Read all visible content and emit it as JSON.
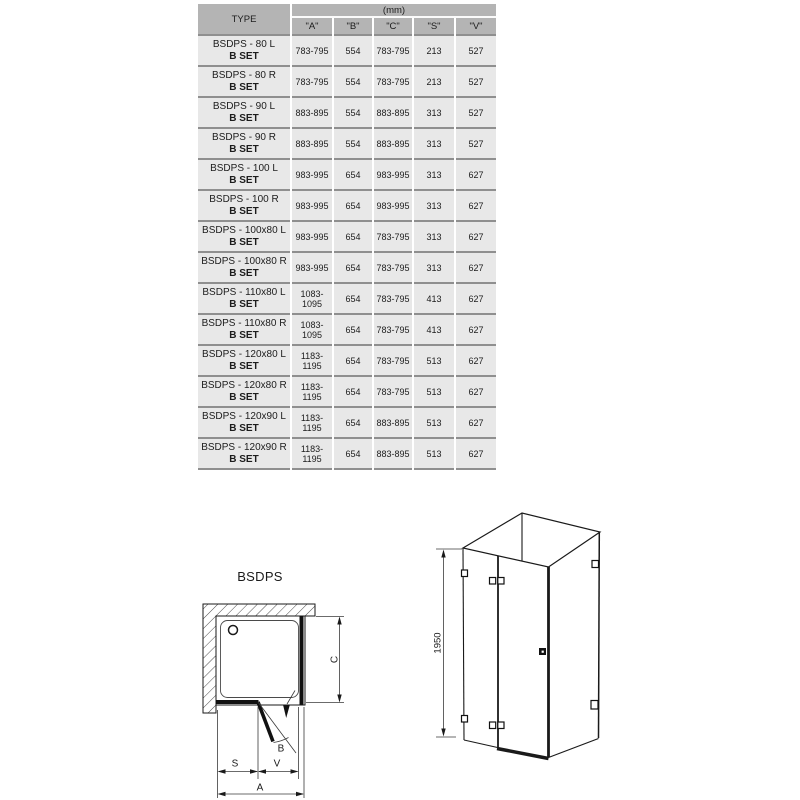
{
  "table": {
    "type_header": "TYPE",
    "unit_header": "(mm)",
    "columns": [
      "\"A\"",
      "\"B\"",
      "\"C\"",
      "\"S\"",
      "\"V\""
    ],
    "rows": [
      {
        "model": "BSDPS - 80 L",
        "set": "B SET",
        "a": "783-795",
        "b": "554",
        "c": "783-795",
        "s": "213",
        "v": "527"
      },
      {
        "model": "BSDPS - 80 R",
        "set": "B SET",
        "a": "783-795",
        "b": "554",
        "c": "783-795",
        "s": "213",
        "v": "527"
      },
      {
        "model": "BSDPS - 90 L",
        "set": "B SET",
        "a": "883-895",
        "b": "554",
        "c": "883-895",
        "s": "313",
        "v": "527"
      },
      {
        "model": "BSDPS - 90 R",
        "set": "B SET",
        "a": "883-895",
        "b": "554",
        "c": "883-895",
        "s": "313",
        "v": "527"
      },
      {
        "model": "BSDPS - 100 L",
        "set": "B SET",
        "a": "983-995",
        "b": "654",
        "c": "983-995",
        "s": "313",
        "v": "627"
      },
      {
        "model": "BSDPS - 100 R",
        "set": "B SET",
        "a": "983-995",
        "b": "654",
        "c": "983-995",
        "s": "313",
        "v": "627"
      },
      {
        "model": "BSDPS - 100x80 L",
        "set": "B SET",
        "a": "983-995",
        "b": "654",
        "c": "783-795",
        "s": "313",
        "v": "627"
      },
      {
        "model": "BSDPS - 100x80 R",
        "set": "B SET",
        "a": "983-995",
        "b": "654",
        "c": "783-795",
        "s": "313",
        "v": "627"
      },
      {
        "model": "BSDPS - 110x80 L",
        "set": "B SET",
        "a": "1083-1095",
        "b": "654",
        "c": "783-795",
        "s": "413",
        "v": "627"
      },
      {
        "model": "BSDPS - 110x80 R",
        "set": "B SET",
        "a": "1083-1095",
        "b": "654",
        "c": "783-795",
        "s": "413",
        "v": "627"
      },
      {
        "model": "BSDPS - 120x80 L",
        "set": "B SET",
        "a": "1183-1195",
        "b": "654",
        "c": "783-795",
        "s": "513",
        "v": "627"
      },
      {
        "model": "BSDPS - 120x80 R",
        "set": "B SET",
        "a": "1183-1195",
        "b": "654",
        "c": "783-795",
        "s": "513",
        "v": "627"
      },
      {
        "model": "BSDPS - 120x90 L",
        "set": "B SET",
        "a": "1183-1195",
        "b": "654",
        "c": "883-895",
        "s": "513",
        "v": "627"
      },
      {
        "model": "BSDPS - 120x90 R",
        "set": "B SET",
        "a": "1183-1195",
        "b": "654",
        "c": "883-895",
        "s": "513",
        "v": "627"
      }
    ]
  },
  "diagram_top_view": {
    "title": "BSDPS",
    "dim_c": "C",
    "dim_s": "S",
    "dim_v": "V",
    "dim_a": "A",
    "angle_b": "B"
  },
  "diagram_iso": {
    "height_label": "1950"
  },
  "colors": {
    "header_bg": "#b4b4b4",
    "cell_bg": "#e8e8e8",
    "row_separator": "#8f8f8f",
    "line": "#1a1a1a"
  }
}
